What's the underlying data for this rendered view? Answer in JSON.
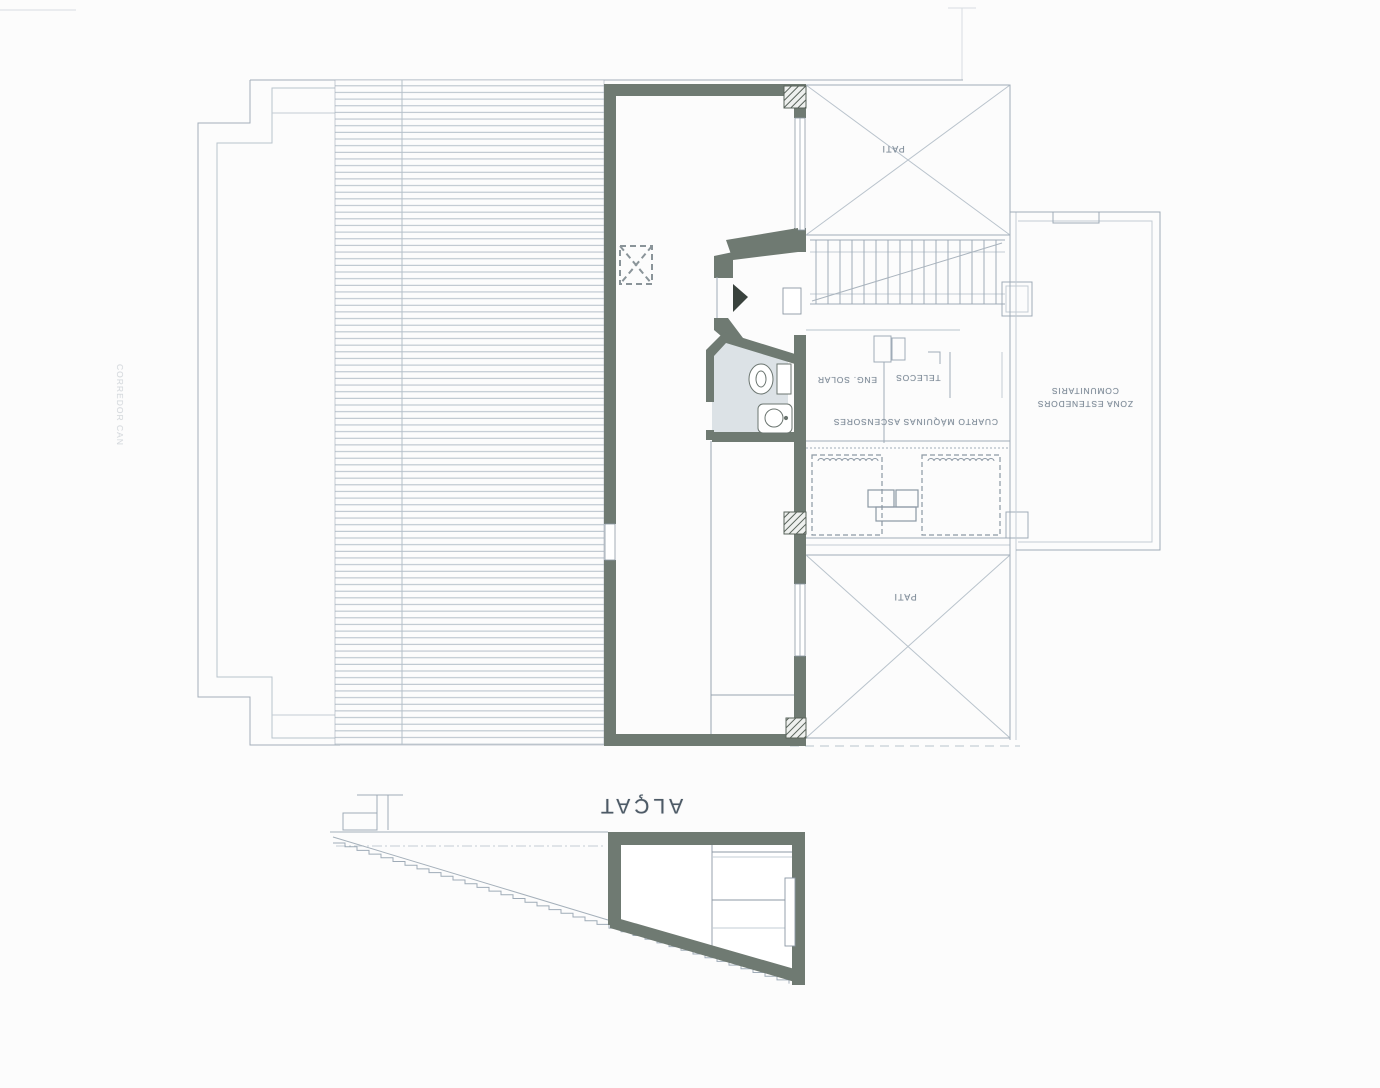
{
  "document": {
    "kind": "scanned architectural roof-plan and section, printed upside down",
    "page_background": "#fcfcfc"
  },
  "labels": {
    "pati_top": "PATI",
    "pati_bottom": "PATI",
    "eng_solar": "ENG. SOLAR",
    "telecos": "TELECOS",
    "cuarto_maquinas": "CUARTO MÁQUINAS ASCENSORES",
    "zona_line1": "ZONA ESTENEDORS",
    "zona_line2": "COMUNITARIS",
    "corredor": "CORREDOR CAN",
    "section_title": "ALÇAT"
  },
  "colors": {
    "wall": "#6f7a72",
    "wall_dark": "#59635b",
    "thin_line": "#9fabb7",
    "faint_line": "#c3ccd4",
    "deck_line": "#b4bfc9",
    "bath_fill": "#dce2e6",
    "label_text": "#7e8b98",
    "triangle": "#39423d"
  }
}
